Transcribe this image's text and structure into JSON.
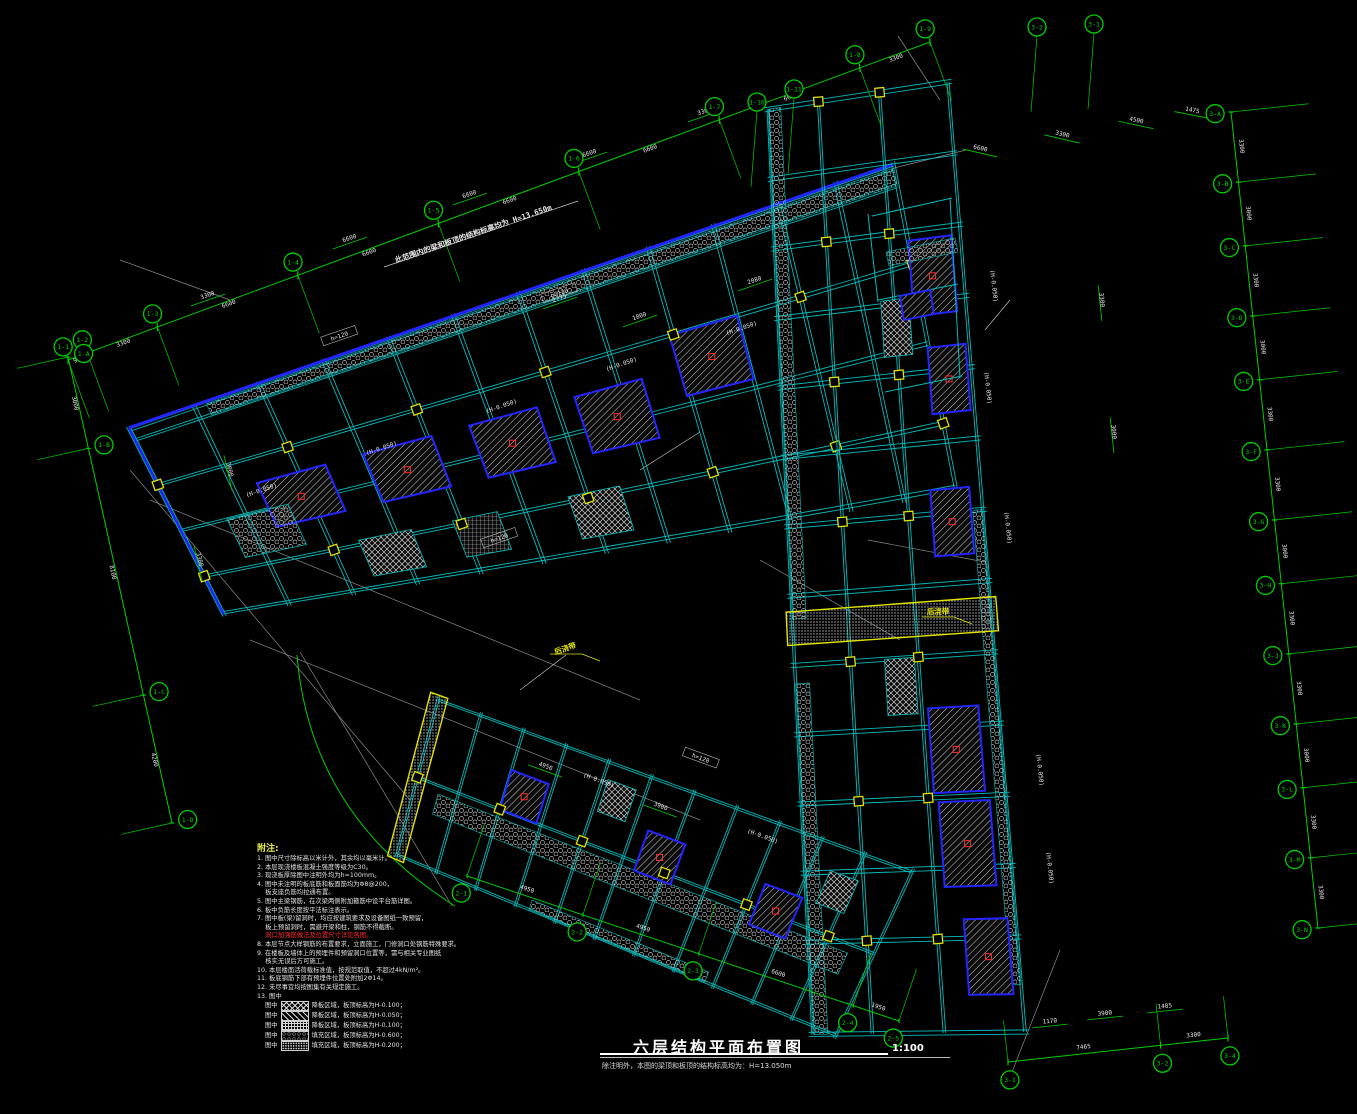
{
  "colors": {
    "green": "#00cf00",
    "cyan": "#00bcbc",
    "blue": "#2424ff",
    "yellow": "#e2e200",
    "white": "#e6e6e6",
    "gray": "#8a8a8a",
    "red": "#ff2a2a"
  },
  "title_block": {
    "title": "六层结构平面布置图",
    "scale": "1:100",
    "subtitle": "除注明外，本图的梁顶和板顶的结构标高均为：H=13.050m"
  },
  "annotations": {
    "top_note": {
      "x": 396,
      "y": 263,
      "r": -18.9,
      "text": "此范围内的梁和板顶的结构标高均为 H=13.650m"
    },
    "joints": [
      {
        "x": 566,
        "y": 651,
        "r": -19,
        "text": "后浇带"
      },
      {
        "x": 938,
        "y": 614,
        "r": 0,
        "text": "后浇带"
      }
    ]
  },
  "notes": {
    "header": "附注:",
    "lines": [
      {
        "t": "1. 图中尺寸除标高以米计外，其余均以毫米计。"
      },
      {
        "t": "2. 本层现浇楼板混凝土强度等级为C30。"
      },
      {
        "t": "3. 现浇板厚除图中注明外均为h=100mm。"
      },
      {
        "t": "4. 图中未注明的板底筋和板面筋均为Φ8@200，"
      },
      {
        "t": "　 板支座负筋均拉通布置。"
      },
      {
        "t": "5. 图中主梁钢筋，在次梁两侧附加箍筋中设平台筋详图。"
      },
      {
        "t": "6. 板中负筋长度按平法标注表示。"
      },
      {
        "t": "7. 图中板(梁)留洞时，均应按建筑要求及设备图纸一致预留，"
      },
      {
        "t": "　 板上预留洞时，需避开梁和柱，钢筋不得截断。"
      },
      {
        "t": "　 洞口加强筋做法及位置尺寸详见各图。",
        "red": true
      },
      {
        "t": "8. 本层节点大样钢筋的布置要求，立面施工，门修洞口处钢筋特殊要求。"
      },
      {
        "t": "9. 在楼板及墙体上的预埋件和预留洞口位置等，需与相关专业图纸"
      },
      {
        "t": "　 核实无误后方可施工。"
      },
      {
        "t": "10. 本层楼面活荷载标准值，按规范取值，不超过4kN/m²。"
      },
      {
        "t": "11. 板底钢筋下部有预埋件位置处附加2Φ14。"
      },
      {
        "t": "12. 未尽事宜均按图集有关规定施工。"
      },
      {
        "t": "13. 图中"
      }
    ],
    "legend": [
      {
        "pattern": "cross",
        "prefix": "图中",
        "text": "降板区域，板顶标高为H-0.100；"
      },
      {
        "pattern": "diag",
        "prefix": "图中",
        "text": "降板区域，板顶标高为H-0.050；"
      },
      {
        "pattern": "grid",
        "prefix": "图中",
        "text": "降板区域，板顶标高为H-0.100；"
      },
      {
        "pattern": "honey",
        "prefix": "图中",
        "text": "填充区域，板顶标高为H-0.600；"
      },
      {
        "pattern": "dots",
        "prefix": "图中",
        "text": "填充区域，板顶标高为H-0.200；"
      }
    ]
  },
  "chains": [
    {
      "id": "axes-top",
      "x1": 68,
      "y1": 360,
      "x2": 930,
      "y2": 42,
      "values": [
        "900",
        "3300",
        "6600",
        "6600",
        "6600",
        "6600",
        "6600",
        "3300"
      ],
      "labels": [
        "1-1",
        "1-2",
        "1-3",
        "1-4",
        "1-5",
        "1-6",
        "1-7",
        "1-8",
        "1-9"
      ],
      "side": -1,
      "off": 14,
      "stem": 62
    },
    {
      "id": "axes-right",
      "x1": 1231,
      "y1": 112,
      "x2": 1318,
      "y2": 928,
      "values": [
        "3300",
        "3000",
        "3300",
        "3000",
        "3300",
        "3300",
        "3000",
        "3300",
        "3300",
        "3000",
        "3300",
        "3300"
      ],
      "labels": [
        "3-A",
        "3-B",
        "3-C",
        "3-D",
        "3-E",
        "3-F",
        "3-G",
        "3-H",
        "3-J",
        "3-K",
        "3-L",
        "3-M",
        "3-N"
      ],
      "side": 1,
      "off": 16,
      "stem": 78
    },
    {
      "id": "axes-bottom-right",
      "x1": 1008,
      "y1": 1062,
      "x2": 1228,
      "y2": 1038,
      "values": [
        "7465",
        "3300"
      ],
      "labels": [
        "3-1",
        "3-2",
        "3-4"
      ],
      "side": 1,
      "off": 18,
      "stem": 42
    },
    {
      "id": "axes-left",
      "x1": 68,
      "y1": 357,
      "x2": 172,
      "y2": 823,
      "values": [
        "3000",
        "8100",
        "4200"
      ],
      "labels": [
        "1-A",
        "1-B",
        "1-C",
        "1-D"
      ],
      "side": -1,
      "off": 16,
      "stem": 52
    },
    {
      "id": "axes-bottom",
      "x1": 467,
      "y1": 876,
      "x2": 899,
      "y2": 1021,
      "values": [
        "4950",
        "4950",
        "6600",
        "1950"
      ],
      "labels": [
        "2-1",
        "2-2",
        "2-3",
        "2-4",
        "2-5"
      ],
      "side": 1,
      "off": 18,
      "stem": 55
    }
  ],
  "bubbles": [
    {
      "x": 1037,
      "y": 27,
      "label": "3-2"
    },
    {
      "x": 1094,
      "y": 24,
      "label": "3-1"
    },
    {
      "x": 757,
      "y": 102,
      "label": "1-10"
    },
    {
      "x": 794,
      "y": 89,
      "label": "1-11"
    }
  ],
  "free_dims": [
    {
      "x": 350,
      "y": 240,
      "r": -19,
      "t": "6600"
    },
    {
      "x": 470,
      "y": 196,
      "r": -19,
      "t": "6600"
    },
    {
      "x": 590,
      "y": 155,
      "r": -19,
      "t": "6600"
    },
    {
      "x": 705,
      "y": 113,
      "r": -19,
      "t": "3300"
    },
    {
      "x": 208,
      "y": 297,
      "r": -19,
      "t": "3300"
    },
    {
      "x": 980,
      "y": 150,
      "r": 13,
      "t": "6600"
    },
    {
      "x": 1062,
      "y": 136,
      "r": 13,
      "t": "3300"
    },
    {
      "x": 1136,
      "y": 122,
      "r": 12,
      "t": "4500"
    },
    {
      "x": 1192,
      "y": 112,
      "r": 11,
      "t": "1475"
    },
    {
      "x": 1100,
      "y": 300,
      "r": 84,
      "t": "3300"
    },
    {
      "x": 1112,
      "y": 432,
      "r": 84,
      "t": "3000"
    },
    {
      "x": 560,
      "y": 300,
      "r": -19,
      "t": "2775"
    },
    {
      "x": 640,
      "y": 318,
      "r": -19,
      "t": "1800"
    },
    {
      "x": 755,
      "y": 282,
      "r": -19,
      "t": "2080"
    },
    {
      "x": 545,
      "y": 768,
      "r": 20,
      "t": "4950"
    },
    {
      "x": 660,
      "y": 808,
      "r": 20,
      "t": "3900"
    },
    {
      "x": 198,
      "y": 560,
      "r": 77,
      "t": "3300"
    },
    {
      "x": 228,
      "y": 470,
      "r": 77,
      "t": "3000"
    },
    {
      "x": 1050,
      "y": 1023,
      "r": -6,
      "t": "1170"
    },
    {
      "x": 1105,
      "y": 1015,
      "r": -6,
      "t": "3900"
    },
    {
      "x": 1165,
      "y": 1008,
      "r": -6,
      "t": "1485"
    }
  ],
  "slab_labels": [
    {
      "x": 262,
      "y": 492,
      "r": -19,
      "t": "(H-0.050)"
    },
    {
      "x": 382,
      "y": 450,
      "r": -19,
      "t": "(H-0.050)"
    },
    {
      "x": 502,
      "y": 408,
      "r": -19,
      "t": "(H-0.050)"
    },
    {
      "x": 622,
      "y": 366,
      "r": -19,
      "t": "(H-0.050)"
    },
    {
      "x": 742,
      "y": 330,
      "r": -19,
      "t": "(H-0.050)"
    },
    {
      "x": 340,
      "y": 338,
      "r": -19,
      "t": "h=120",
      "b": 1
    },
    {
      "x": 560,
      "y": 295,
      "r": -19,
      "t": "h=120",
      "b": 1
    },
    {
      "x": 500,
      "y": 540,
      "r": -19,
      "t": "h=120",
      "b": 1
    },
    {
      "x": 992,
      "y": 286,
      "r": 84,
      "t": "(H-0.050)"
    },
    {
      "x": 986,
      "y": 388,
      "r": 84,
      "t": "(H-0.050)"
    },
    {
      "x": 1006,
      "y": 528,
      "r": 84,
      "t": "(H-0.050)"
    },
    {
      "x": 1038,
      "y": 770,
      "r": 84,
      "t": "(H-0.050)"
    },
    {
      "x": 1048,
      "y": 868,
      "r": 84,
      "t": "(H-0.050)"
    },
    {
      "x": 598,
      "y": 782,
      "r": 20,
      "t": "(H-0.050)"
    },
    {
      "x": 762,
      "y": 838,
      "r": 20,
      "t": "(H-0.050)"
    },
    {
      "x": 700,
      "y": 760,
      "r": 20,
      "t": "h=120",
      "b": 1
    }
  ]
}
